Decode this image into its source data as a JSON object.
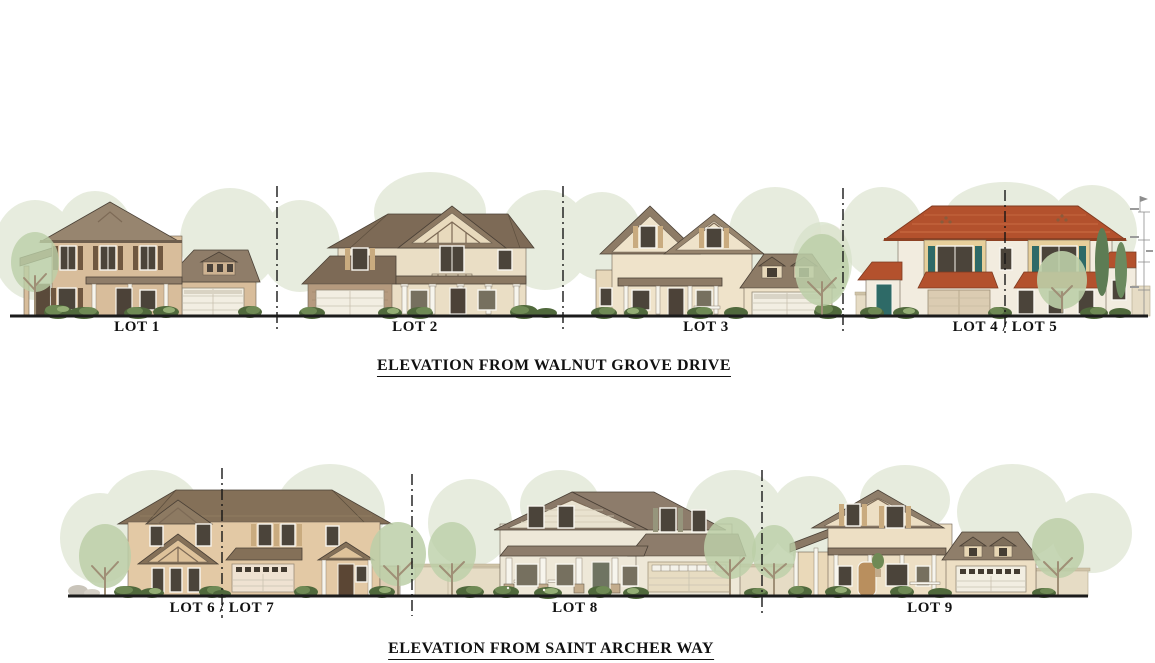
{
  "top_elevation": {
    "title": "ELEVATION FROM WALNUT GROVE DRIVE",
    "lots": [
      {
        "label": "LOT 1"
      },
      {
        "label": "LOT 2"
      },
      {
        "label": "LOT 3"
      },
      {
        "label": "LOT 4 / LOT 5"
      }
    ]
  },
  "bottom_elevation": {
    "title": "ELEVATION FROM SAINT ARCHER WAY",
    "lots": [
      {
        "label": "LOT 6 / LOT 7"
      },
      {
        "label": "LOT 8"
      },
      {
        "label": "LOT 9"
      }
    ]
  },
  "palette": {
    "roof_brown": "#8a7663",
    "roof_dark_brown": "#7d6a56",
    "roof_red_tile": "#b3512d",
    "wall_tan": "#d8bd9b",
    "wall_cream": "#eadec5",
    "wall_white": "#f2ecdf",
    "accent_yellow": "#e7cf9b",
    "accent_teal": "#2e6a67",
    "foliage_pale": "#dfe6d4",
    "foliage_green": "#bccfa8",
    "shrub_green": "#6f8a55",
    "ground_line": "#1b1b1b",
    "text": "#111111"
  }
}
